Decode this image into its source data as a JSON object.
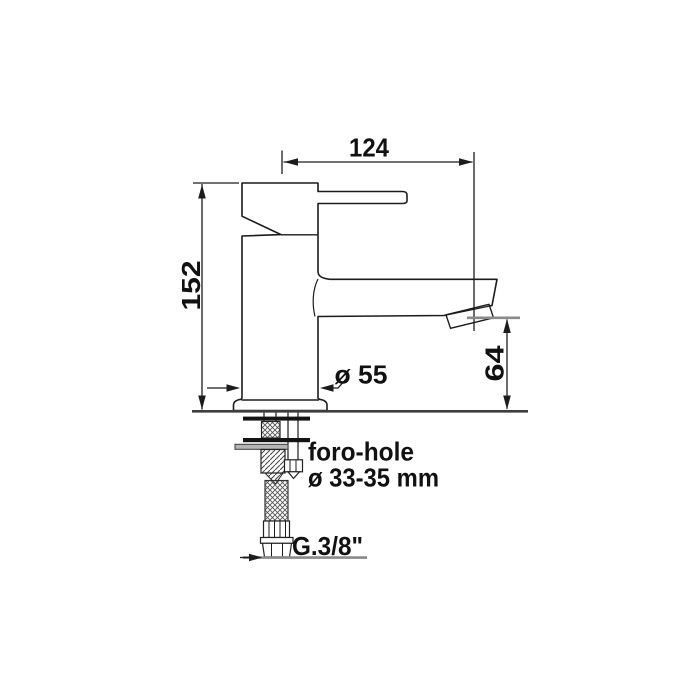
{
  "dimensions": {
    "spout_reach_mm": "124",
    "total_height_mm": "152",
    "body_diameter": "ø 55",
    "spout_height_mm": "64"
  },
  "annotations": {
    "hole_label": "foro-hole",
    "hole_diameter": "ø 33-35 mm",
    "connection_thread": "G.3/8\""
  },
  "colors": {
    "line": "#1c1c1c",
    "gray_line": "#8a8a8a",
    "text": "#111111",
    "background": "#ffffff"
  }
}
